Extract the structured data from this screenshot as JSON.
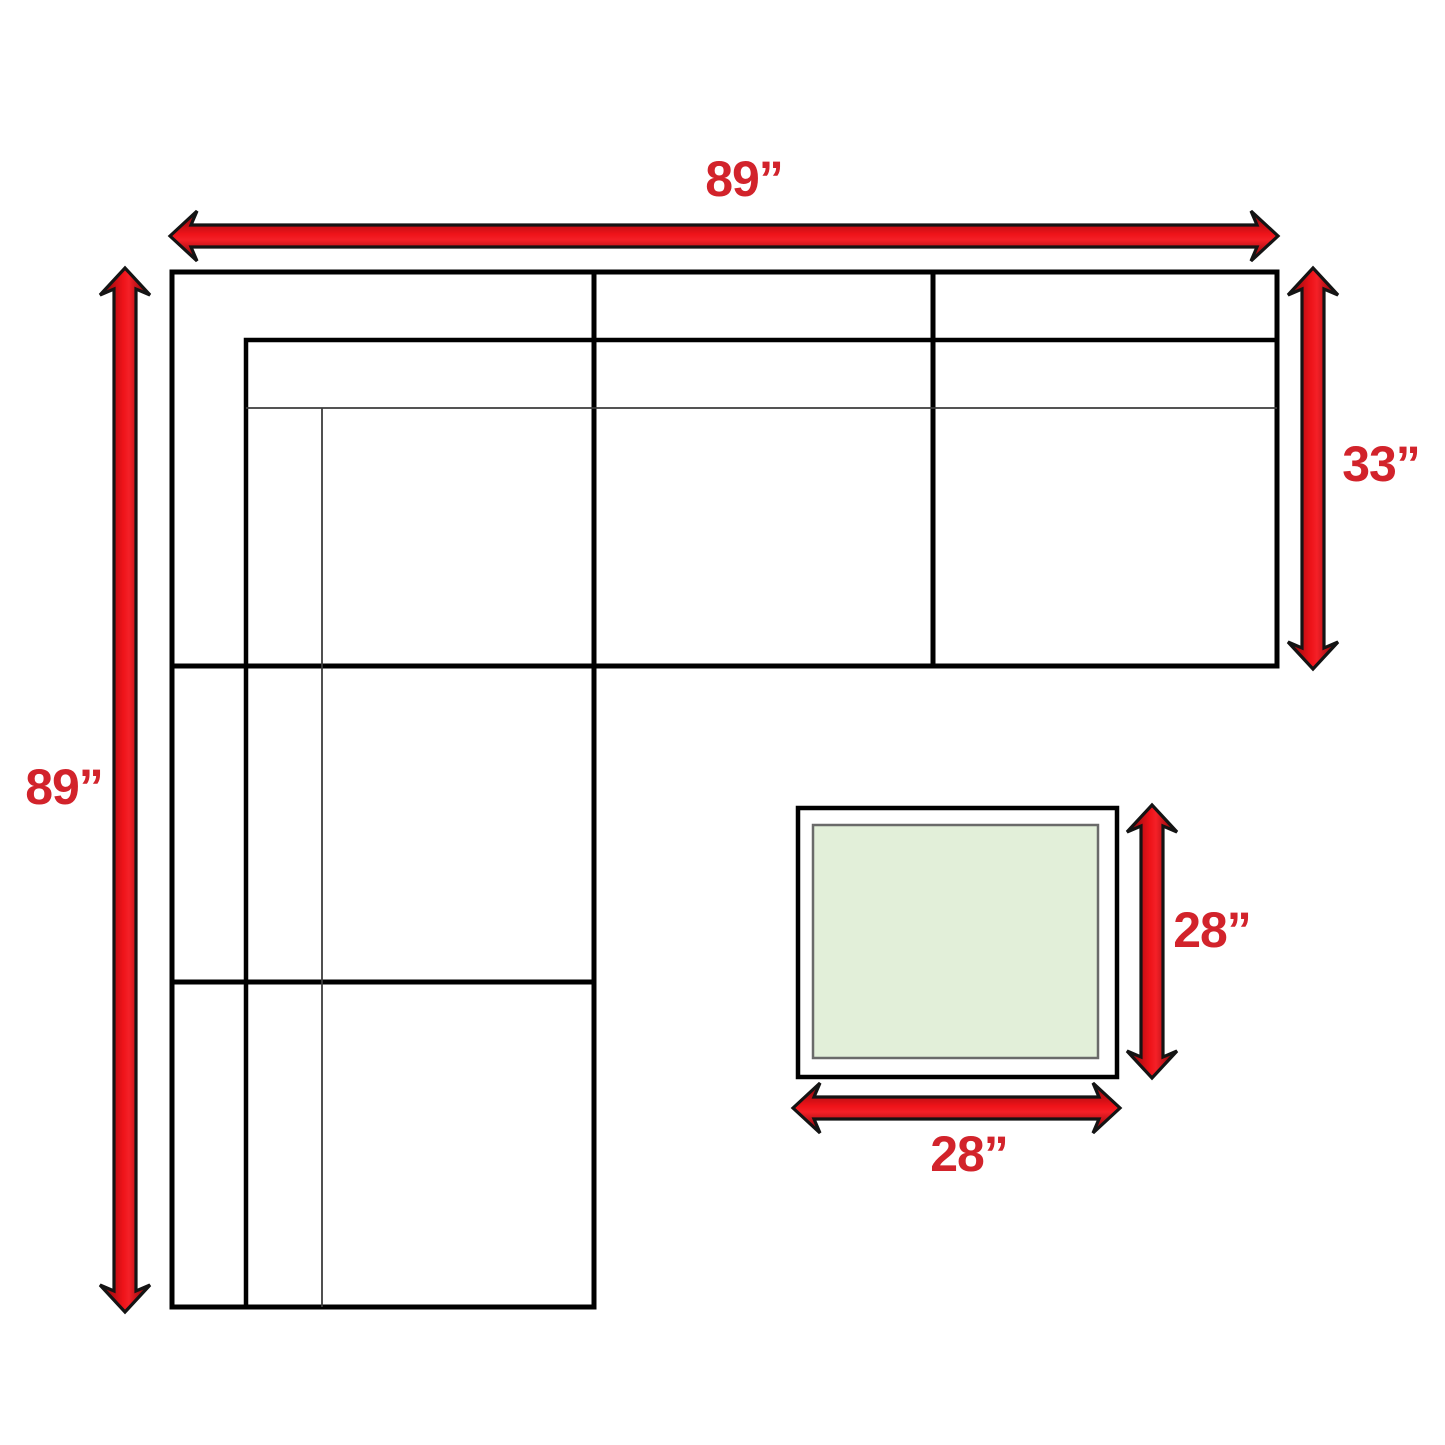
{
  "title": "Sectional sofa and ottoman dimension diagram",
  "colors": {
    "background": "#ffffff",
    "sofa_line": "#000000",
    "thin_line": "#3c3c3c",
    "arrow_outline": "#141414",
    "arrow_red_bright": "#ee1319",
    "arrow_red_mid": "#9e0a0f",
    "arrow_red_edge": "#260a0a",
    "label_red": "#d2232b",
    "ottoman_fill": "#e2efd9",
    "ottoman_inner_stroke": "#6a6a6a"
  },
  "sectional": {
    "outline": [
      [
        172,
        272
      ],
      [
        1277,
        272
      ],
      [
        1277,
        666
      ],
      [
        594,
        666
      ],
      [
        594,
        1307
      ],
      [
        172,
        1307
      ]
    ],
    "dividers": [
      {
        "x1": 172,
        "y1": 666,
        "x2": 1277,
        "y2": 666
      },
      {
        "x1": 172,
        "y1": 982,
        "x2": 594,
        "y2": 982
      },
      {
        "x1": 594,
        "y1": 272,
        "x2": 594,
        "y2": 1307
      },
      {
        "x1": 933,
        "y1": 272,
        "x2": 933,
        "y2": 666
      }
    ],
    "backrest_polyline": [
      [
        1277,
        340
      ],
      [
        246,
        340
      ],
      [
        246,
        1307
      ]
    ],
    "seat_lines": [
      {
        "x1": 246,
        "y1": 408,
        "x2": 1277,
        "y2": 408
      },
      {
        "x1": 322,
        "y1": 408,
        "x2": 322,
        "y2": 1307
      }
    ]
  },
  "ottoman": {
    "outer": {
      "x": 798,
      "y": 808,
      "w": 319,
      "h": 269
    },
    "inner": {
      "x": 813,
      "y": 825,
      "w": 285,
      "h": 233
    }
  },
  "dimensions": {
    "sofa_width": {
      "label": "89”",
      "orient": "h",
      "a": 170,
      "b": 1278,
      "pos": 236,
      "lx": 744,
      "ly": 179
    },
    "sofa_height": {
      "label": "89”",
      "orient": "v",
      "a": 268,
      "b": 1312,
      "pos": 125,
      "lx": 64,
      "ly": 787
    },
    "sofa_depth": {
      "label": "33”",
      "orient": "v",
      "a": 268,
      "b": 669,
      "pos": 1313,
      "lx": 1381,
      "ly": 464
    },
    "ottoman_height": {
      "label": "28”",
      "orient": "v",
      "a": 805,
      "b": 1078,
      "pos": 1152,
      "lx": 1212,
      "ly": 930
    },
    "ottoman_width": {
      "label": "28”",
      "orient": "h",
      "a": 793,
      "b": 1120,
      "pos": 1108,
      "lx": 969,
      "ly": 1154
    }
  }
}
